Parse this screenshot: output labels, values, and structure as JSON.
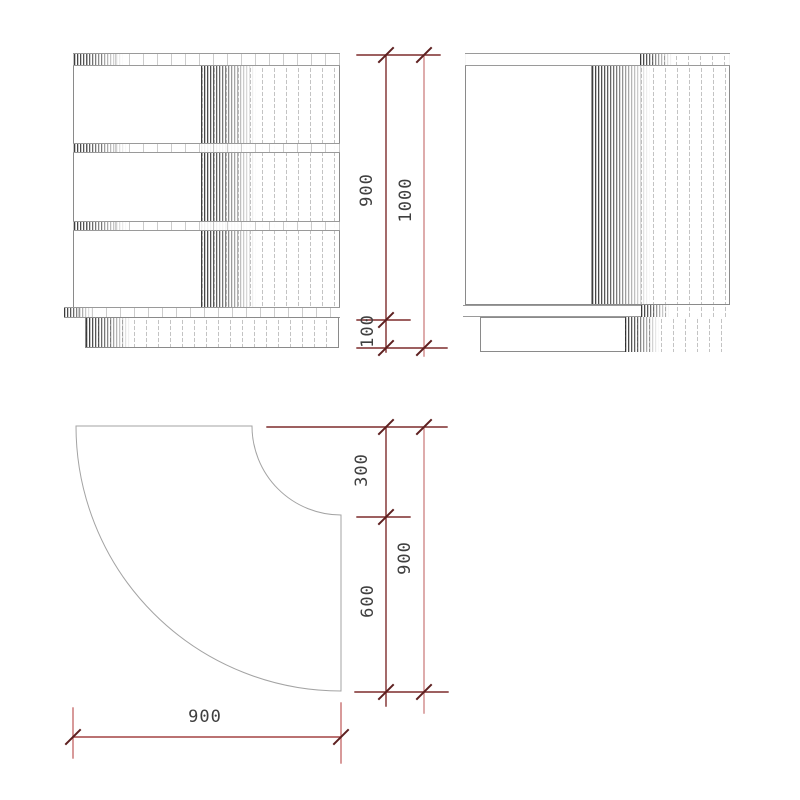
{
  "dimensions": {
    "front_cabinet_height": "900",
    "front_total_height": "1000",
    "front_plinth_height": "100",
    "plan_corner_radius": "300",
    "plan_side_straight": "600",
    "plan_depth": "900",
    "plan_width": "900"
  },
  "colors": {
    "dimension_line_dark": "#7d2c2c",
    "dimension_line_light": "#d08888",
    "dimension_line_mid": "#a34444",
    "dimension_text": "#3f3f3f",
    "drawing_outline": "#8a8a8a"
  }
}
